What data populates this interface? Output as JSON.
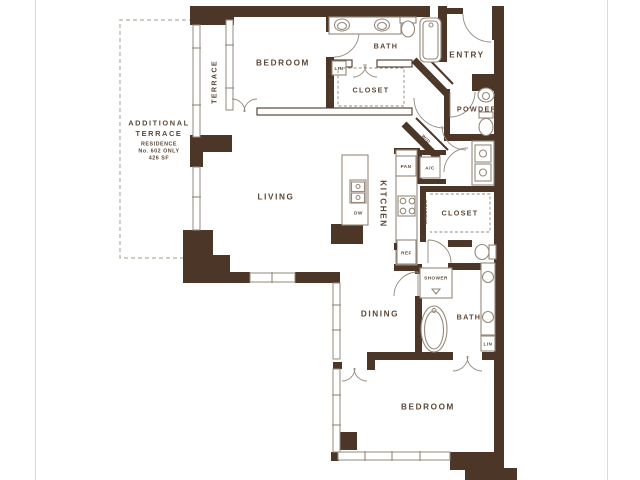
{
  "colors": {
    "wall": "#4b3627",
    "line": "#95897c",
    "text": "#5d4736",
    "dash": "#b6ad9f",
    "background": "#ffffff"
  },
  "rooms": {
    "terrace": "TERRACE",
    "bedroom_top": "BEDROOM",
    "bath_top": "BATH",
    "closet_top": "CLOSET",
    "entry": "ENTRY",
    "closet_diagonal": "CLOSET",
    "powder": "POWDER",
    "living": "LIVING",
    "kitchen": "KITCHEN",
    "closet_walkin": "CLOSET",
    "dining": "DINING",
    "bath_master": "BATH",
    "bedroom_bottom": "BEDROOM"
  },
  "fixtures": {
    "linen_top": "LIN",
    "shelves_top": "SHELVES",
    "washer_dryer": "W/D",
    "pantry": "PAN",
    "air_conditioner": "A/C",
    "refrigerator": "REF",
    "dishwasher": "DW",
    "shelves_walkin": "SHELVES",
    "shower": "SHOWER",
    "linen_bottom": "LIN"
  },
  "terrace_note": {
    "line1": "ADDITIONAL",
    "line2": "TERRACE",
    "line3": "RESIDENCE",
    "line4": "No. 602 ONLY",
    "line5": "426 SF"
  }
}
